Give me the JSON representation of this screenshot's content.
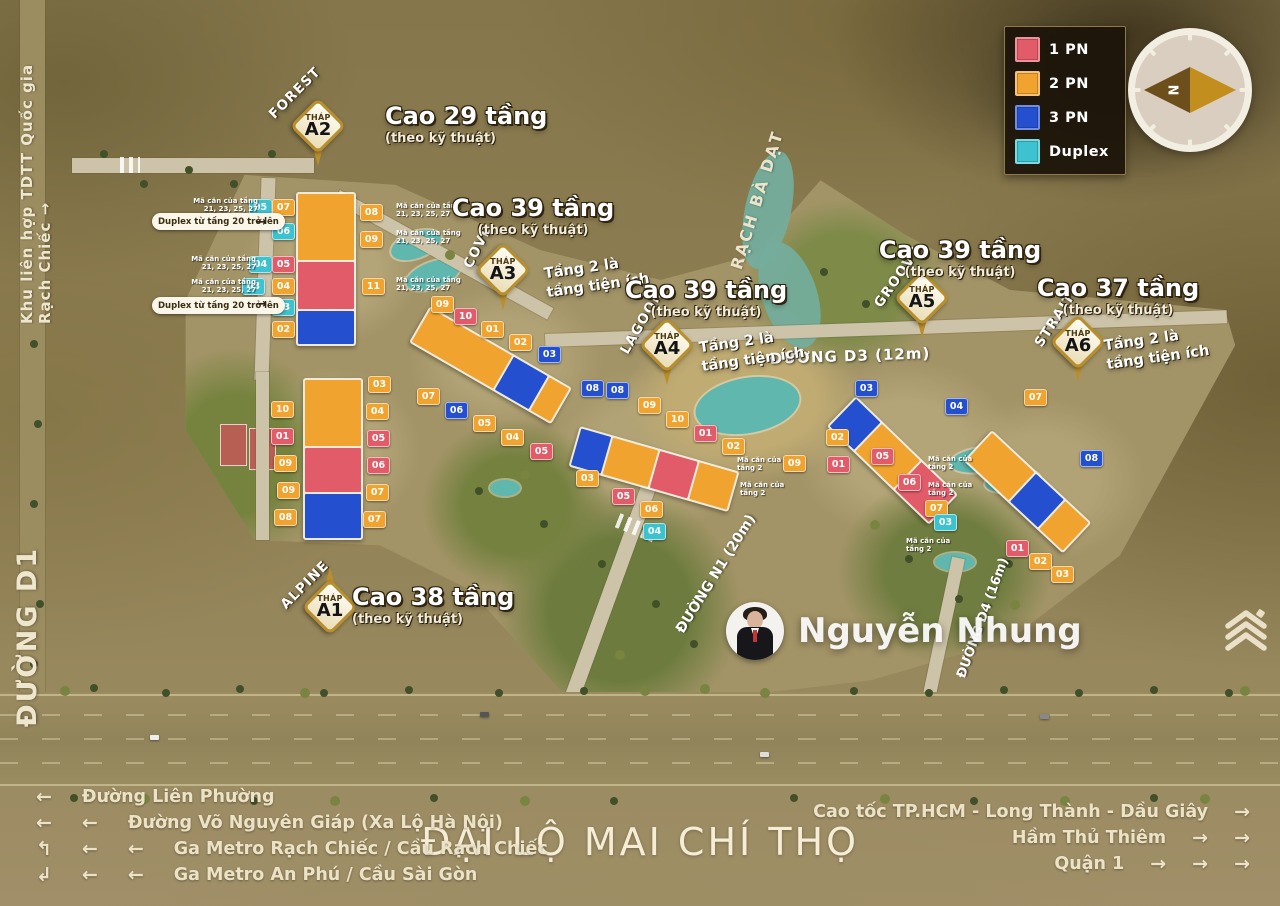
{
  "colors": {
    "1pn": "#e25b68",
    "2pn": "#f0a32e",
    "3pn": "#2450cf",
    "duplex": "#3cc3cf"
  },
  "legend": {
    "items": [
      {
        "label": "1 PN",
        "color": "#e25b68"
      },
      {
        "label": "2 PN",
        "color": "#f0a32e"
      },
      {
        "label": "3 PN",
        "color": "#2450cf"
      },
      {
        "label": "Duplex",
        "color": "#3cc3cf"
      }
    ]
  },
  "compass": {
    "north": "N"
  },
  "edges": {
    "top_left_vertical": "Khu liên hợp TDTT Quốc gia Rạch Chiếc →",
    "left_road": "ĐƯỜNG D1",
    "waterway": "RẠCH BÀ DẠT"
  },
  "roads": {
    "d3": "ĐƯỜNG D3 (12m)",
    "n1": "ĐƯỜNG N1 (20m)",
    "d4": "ĐƯỜNG D4 (16m)",
    "boulevard": "ĐẠI LỘ MAI CHÍ THỌ"
  },
  "towers": [
    {
      "id": "A2",
      "area": "FOREST",
      "thap": "THÁP",
      "code": "A2",
      "height": "Cao 29 tầng",
      "tech": "(theo kỹ thuật)"
    },
    {
      "id": "A3",
      "area": "COVE",
      "thap": "THÁP",
      "code": "A3",
      "height": "Cao 39 tầng",
      "tech": "(theo kỹ thuật)",
      "note1": "Tầng 2 là",
      "note2": "tầng tiện ích"
    },
    {
      "id": "A4",
      "area": "LAGOON",
      "thap": "THÁP",
      "code": "A4",
      "height": "Cao 39 tầng",
      "tech": "(theo kỹ thuật)",
      "note1": "Tầng 2 là",
      "note2": "tầng tiện ích"
    },
    {
      "id": "A5",
      "area": "GROOVE",
      "thap": "THÁP",
      "code": "A5",
      "height": "Cao 39 tầng",
      "tech": "(theo kỹ thuật)"
    },
    {
      "id": "A6",
      "area": "STRAIT",
      "thap": "THÁP",
      "code": "A6",
      "height": "Cao 37 tầng",
      "tech": "(theo kỹ thuật)",
      "note1": "Tầng 2 là",
      "note2": "tầng tiện ích"
    },
    {
      "id": "A1",
      "area": "ALPINE",
      "thap": "THÁP",
      "code": "A1",
      "height": "Cao 38 tầng",
      "tech": "(theo kỹ thuật)"
    }
  ],
  "duplex_pills": [
    {
      "text": "Duplex từ tầng 20 trở lên",
      "arrow": "→"
    },
    {
      "text": "Duplex từ tầng 20 trở lên",
      "arrow": "→"
    }
  ],
  "unit_notes": [
    {
      "x": 258,
      "y": 197,
      "align": "right",
      "lines": [
        "Mã căn của tầng",
        "21, 23, 25, 27"
      ]
    },
    {
      "x": 256,
      "y": 255,
      "align": "right",
      "lines": [
        "Mã căn của tầng",
        "21, 23, 25, 27"
      ]
    },
    {
      "x": 256,
      "y": 278,
      "align": "right",
      "lines": [
        "Mã căn của tầng",
        "21, 23, 25, 27"
      ]
    },
    {
      "x": 396,
      "y": 202,
      "align": "left",
      "lines": [
        "Mã căn của tầng",
        "21, 23, 25, 27"
      ]
    },
    {
      "x": 396,
      "y": 229,
      "align": "left",
      "lines": [
        "Mã căn của tầng",
        "21, 23, 25, 27"
      ]
    },
    {
      "x": 396,
      "y": 276,
      "align": "left",
      "lines": [
        "Mã căn của tầng",
        "21, 23, 25, 27"
      ]
    },
    {
      "x": 737,
      "y": 456,
      "align": "left",
      "lines": [
        "Mã căn của",
        "tầng 2"
      ]
    },
    {
      "x": 740,
      "y": 481,
      "align": "left",
      "lines": [
        "Mã căn của",
        "tầng 2"
      ]
    },
    {
      "x": 928,
      "y": 455,
      "align": "left",
      "lines": [
        "Mã căn của",
        "tầng 2"
      ]
    },
    {
      "x": 928,
      "y": 481,
      "align": "left",
      "lines": [
        "Mã căn của",
        "tầng 2"
      ]
    },
    {
      "x": 906,
      "y": 537,
      "align": "left",
      "lines": [
        "Mã căn của",
        "tầng 2"
      ]
    }
  ],
  "unit_badges": [
    {
      "n": "05",
      "t": "duplex",
      "x": 260,
      "y": 207
    },
    {
      "n": "07",
      "t": "2pn",
      "x": 283,
      "y": 207
    },
    {
      "n": "06",
      "t": "duplex",
      "x": 283,
      "y": 231
    },
    {
      "n": "04",
      "t": "duplex",
      "x": 260,
      "y": 264
    },
    {
      "n": "05",
      "t": "1pn",
      "x": 283,
      "y": 264
    },
    {
      "n": "03",
      "t": "duplex",
      "x": 253,
      "y": 286
    },
    {
      "n": "04",
      "t": "2pn",
      "x": 283,
      "y": 286
    },
    {
      "n": "03",
      "t": "duplex",
      "x": 283,
      "y": 307
    },
    {
      "n": "02",
      "t": "2pn",
      "x": 283,
      "y": 329
    },
    {
      "n": "08",
      "t": "2pn",
      "x": 371,
      "y": 212
    },
    {
      "n": "09",
      "t": "2pn",
      "x": 371,
      "y": 239
    },
    {
      "n": "11",
      "t": "2pn",
      "x": 373,
      "y": 286
    },
    {
      "n": "10",
      "t": "2pn",
      "x": 282,
      "y": 409
    },
    {
      "n": "01",
      "t": "1pn",
      "x": 282,
      "y": 436
    },
    {
      "n": "09",
      "t": "2pn",
      "x": 285,
      "y": 463
    },
    {
      "n": "09",
      "t": "2pn",
      "x": 288,
      "y": 490
    },
    {
      "n": "08",
      "t": "2pn",
      "x": 285,
      "y": 517
    },
    {
      "n": "03",
      "t": "2pn",
      "x": 379,
      "y": 384
    },
    {
      "n": "04",
      "t": "2pn",
      "x": 377,
      "y": 411
    },
    {
      "n": "05",
      "t": "1pn",
      "x": 378,
      "y": 438
    },
    {
      "n": "06",
      "t": "1pn",
      "x": 378,
      "y": 465
    },
    {
      "n": "07",
      "t": "2pn",
      "x": 377,
      "y": 492
    },
    {
      "n": "07",
      "t": "2pn",
      "x": 374,
      "y": 519
    },
    {
      "n": "09",
      "t": "2pn",
      "x": 442,
      "y": 304
    },
    {
      "n": "10",
      "t": "1pn",
      "x": 465,
      "y": 316
    },
    {
      "n": "01",
      "t": "2pn",
      "x": 492,
      "y": 329
    },
    {
      "n": "02",
      "t": "2pn",
      "x": 520,
      "y": 342
    },
    {
      "n": "03",
      "t": "3pn",
      "x": 549,
      "y": 354
    },
    {
      "n": "07",
      "t": "2pn",
      "x": 428,
      "y": 396
    },
    {
      "n": "06",
      "t": "3pn",
      "x": 456,
      "y": 410
    },
    {
      "n": "05",
      "t": "2pn",
      "x": 484,
      "y": 423
    },
    {
      "n": "04",
      "t": "2pn",
      "x": 512,
      "y": 437
    },
    {
      "n": "05",
      "t": "1pn",
      "x": 541,
      "y": 451
    },
    {
      "n": "08",
      "t": "3pn",
      "x": 592,
      "y": 388
    },
    {
      "n": "08",
      "t": "3pn",
      "x": 617,
      "y": 390
    },
    {
      "n": "09",
      "t": "2pn",
      "x": 649,
      "y": 405
    },
    {
      "n": "10",
      "t": "2pn",
      "x": 677,
      "y": 419
    },
    {
      "n": "01",
      "t": "1pn",
      "x": 705,
      "y": 433
    },
    {
      "n": "02",
      "t": "2pn",
      "x": 733,
      "y": 446
    },
    {
      "n": "03",
      "t": "2pn",
      "x": 587,
      "y": 478
    },
    {
      "n": "05",
      "t": "1pn",
      "x": 623,
      "y": 496
    },
    {
      "n": "06",
      "t": "2pn",
      "x": 651,
      "y": 509
    },
    {
      "n": "04",
      "t": "duplex",
      "x": 654,
      "y": 531
    },
    {
      "n": "03",
      "t": "3pn",
      "x": 866,
      "y": 388
    },
    {
      "n": "04",
      "t": "3pn",
      "x": 956,
      "y": 406
    },
    {
      "n": "02",
      "t": "2pn",
      "x": 837,
      "y": 437
    },
    {
      "n": "09",
      "t": "2pn",
      "x": 794,
      "y": 463
    },
    {
      "n": "01",
      "t": "1pn",
      "x": 838,
      "y": 464
    },
    {
      "n": "05",
      "t": "1pn",
      "x": 882,
      "y": 456
    },
    {
      "n": "06",
      "t": "1pn",
      "x": 909,
      "y": 482
    },
    {
      "n": "07",
      "t": "2pn",
      "x": 936,
      "y": 508
    },
    {
      "n": "03",
      "t": "duplex",
      "x": 945,
      "y": 522
    },
    {
      "n": "07",
      "t": "2pn",
      "x": 1035,
      "y": 397
    },
    {
      "n": "08",
      "t": "3pn",
      "x": 1091,
      "y": 458
    },
    {
      "n": "01",
      "t": "1pn",
      "x": 1017,
      "y": 548
    },
    {
      "n": "02",
      "t": "2pn",
      "x": 1040,
      "y": 561
    },
    {
      "n": "03",
      "t": "2pn",
      "x": 1062,
      "y": 574
    }
  ],
  "agent": {
    "name": "Nguyễn Nhung"
  },
  "directions_left": [
    {
      "arrows": [
        "←"
      ],
      "label": "Đường Liên Phường"
    },
    {
      "arrows": [
        "←",
        "←"
      ],
      "label": "Đường Võ Nguyên Giáp (Xa Lộ Hà Nội)"
    },
    {
      "arrows": [
        "↰",
        "←",
        "←"
      ],
      "label": "Ga Metro Rạch Chiếc / Cầu Rạch Chiếc"
    },
    {
      "arrows": [
        "↲",
        "←",
        "←"
      ],
      "label": "Ga Metro An Phú / Cầu Sài Gòn"
    }
  ],
  "directions_right": [
    {
      "label": "Cao tốc TP.HCM - Long Thành - Dầu Giây",
      "arrows": [
        "→"
      ]
    },
    {
      "label": "Hầm Thủ Thiêm",
      "arrows": [
        "→",
        "→"
      ]
    },
    {
      "label": "Quận 1",
      "arrows": [
        "→",
        "→",
        "→"
      ]
    }
  ]
}
